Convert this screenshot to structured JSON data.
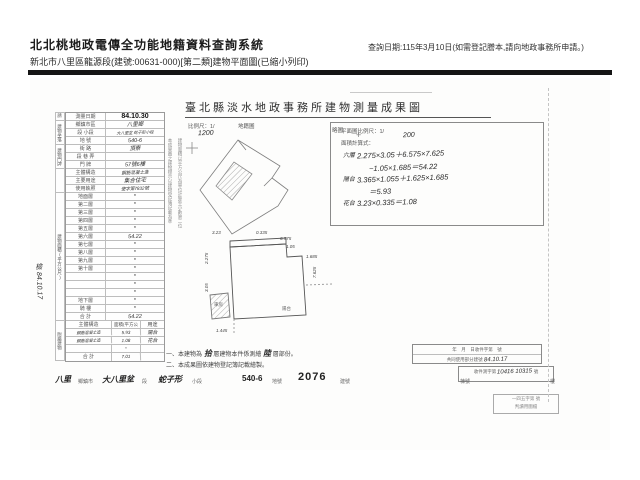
{
  "header": {
    "system_title": "北北桃地政電傳全功能地籍資料查詢系統",
    "subtitle": "新北市八里區龍源段(建號:00631-000)[第二類]建物平面圖(已縮小列印)",
    "query_date": "查詢日期:115年3月10日(如需登記謄本,請向地政事務所申請。)"
  },
  "document": {
    "title": "臺北縣淡水地政事務所建物測量成果圖",
    "form": {
      "applicant_label": "申請人",
      "survey_date": {
        "label": "測量日期",
        "value": "84.10.30"
      },
      "location_group": "建物坐落",
      "location_rows": [
        {
          "label": "鄉鎮市區",
          "value": "八里鄉"
        },
        {
          "label": "段 小段",
          "value": "大八里坌 蛇子形小段"
        },
        {
          "label": "地 號",
          "value": "540-6"
        }
      ],
      "address_group": "建物門牌",
      "address_rows": [
        {
          "label": "街 路",
          "value": "頂寮"
        },
        {
          "label": "段 巷 弄",
          "value": ""
        },
        {
          "label": "門 牌",
          "value": "57號6樓"
        }
      ],
      "detail_rows": [
        {
          "label": "主體構造",
          "value": "鋼筋混凝土造"
        },
        {
          "label": "主要用途",
          "value": "集合住宅"
        },
        {
          "label": "使用執照",
          "value": "使字第7832號"
        }
      ],
      "area_group": "建物面積(平方公尺)",
      "floor_rows": [
        {
          "label": "地面層",
          "value": "*"
        },
        {
          "label": "第二層",
          "value": "*"
        },
        {
          "label": "第三層",
          "value": "*"
        },
        {
          "label": "第四層",
          "value": "*"
        },
        {
          "label": "第五層",
          "value": "*"
        },
        {
          "label": "第六層",
          "value": "54.22"
        },
        {
          "label": "第七層",
          "value": "*"
        },
        {
          "label": "第八層",
          "value": "*"
        },
        {
          "label": "第九層",
          "value": "*"
        },
        {
          "label": "第十層",
          "value": "*"
        },
        {
          "label": "",
          "value": "*"
        },
        {
          "label": "",
          "value": "*"
        },
        {
          "label": "",
          "value": "*"
        },
        {
          "label": "地下層",
          "value": "*"
        },
        {
          "label": "騎 樓",
          "value": "*"
        },
        {
          "label": "合 計",
          "value": "54.22"
        }
      ],
      "annex_group": "附屬建物",
      "annex_header": {
        "c1": "主體構造",
        "c2": "面積(平方公尺)",
        "c3": "用途"
      },
      "annex_rows": [
        {
          "c1": "鋼筋混凝土造",
          "c2": "5.93",
          "c3": "陽台"
        },
        {
          "c1": "鋼筋混凝土造",
          "c2": "1.08",
          "c3": "花台"
        },
        {
          "c1": "",
          "c2": "*",
          "c3": ""
        },
        {
          "c1": "合 計",
          "c2": "7.01",
          "c3": ""
        }
      ],
      "side_note_1": "本成果圖之建物標示以建物登記簿記載為準",
      "side_note_2": "建物面積以平方公尺為單位計算至小數第二位",
      "margin_note": "檢 84.10.17"
    },
    "sketch": {
      "scale_label": "比例尺：1/",
      "scale_value": "1200",
      "label": "地籍圖",
      "sub_label": "略圖",
      "cross": "+"
    },
    "plan": {
      "scale_label": "平面圖比例尺：1/",
      "scale_value": "200",
      "calc_label": "面積計算式：",
      "calc_lines": [
        {
          "name": "六層",
          "line1": "2.275×3.05＋6.575×7.625",
          "line2": "−1.05×1.685＝54.22"
        },
        {
          "name": "陽台",
          "line1": "3.365×1.055＋1.625×1.685",
          "line2": "＝5.93"
        },
        {
          "name": "花台",
          "line1": "3.23×0.335＝1.08",
          "line2": ""
        }
      ],
      "dims": {
        "strip_w": "3.23",
        "strip_h": "0.335",
        "top": "6.575",
        "left_top": "2.275",
        "left_bot": "3.05",
        "right": "7.625",
        "notch_w": "1.05",
        "notch_h": "1.685",
        "bottom": "1.445",
        "room1": "車房",
        "room2": "陽台"
      }
    },
    "stamp": {
      "line1": "一四五字第 號",
      "line2": "判讀用圖檔"
    },
    "notes": {
      "line1_prefix": "一、本建物為",
      "line1_hw1": "拾",
      "line1_mid": "層建物本件係測繪",
      "line1_hw2": "陸",
      "line1_suffix": "層部份。",
      "line2": "二、本成果圖依建物登記簿記載繪製。"
    },
    "receipt": {
      "row1": "年　月　日收件字第　號",
      "row2_label": "共同使用部分建號",
      "row2_value": "84.10.17",
      "row3_label": "收件測字第",
      "row3_value": "10416 10315",
      "row3_suffix": "號"
    },
    "footer": {
      "items": [
        {
          "value": "八里",
          "label": "鄉鎮市"
        },
        {
          "value": "大八里坌",
          "label": "段"
        },
        {
          "value": "蛇子形",
          "label": "小段"
        },
        {
          "value": "540-6",
          "label": "地號"
        },
        {
          "value": "2076",
          "label": "建號"
        },
        {
          "value": "",
          "label": "棟號"
        },
        {
          "value": "",
          "label": "樓"
        }
      ]
    }
  }
}
